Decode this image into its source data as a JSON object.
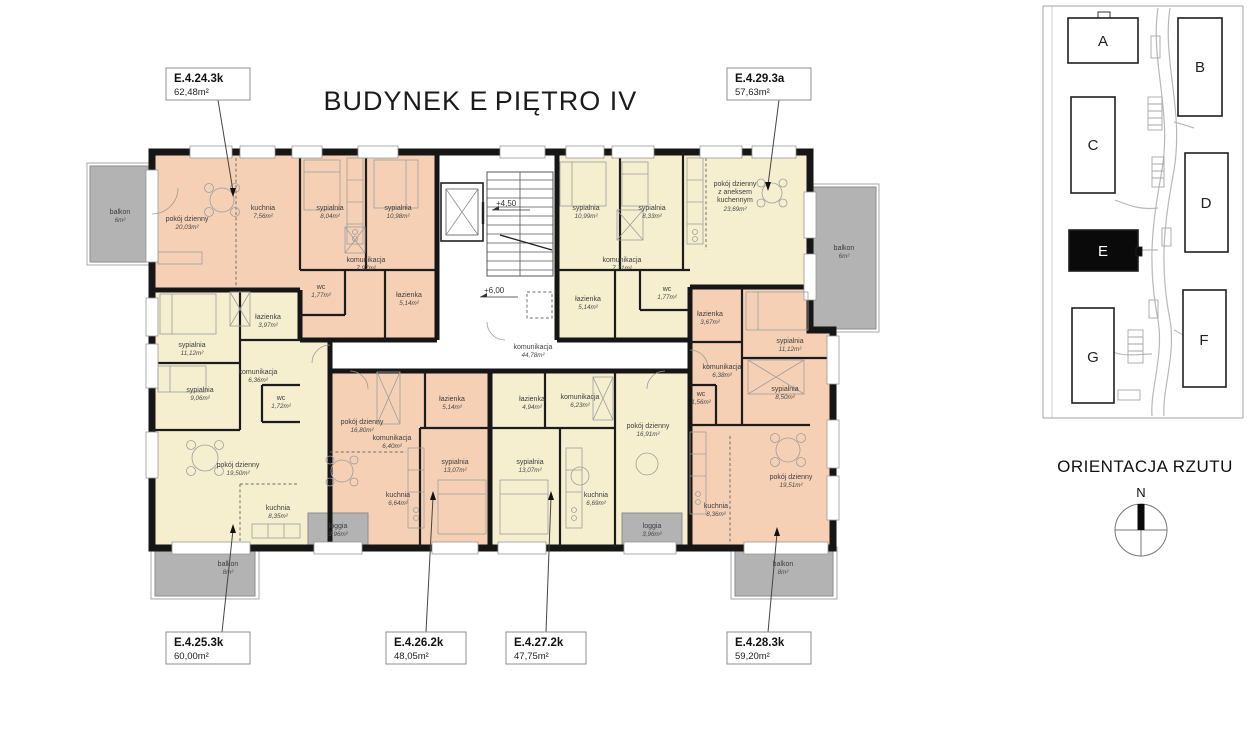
{
  "header": {
    "building": "BUDYNEK E",
    "floor": "PIĘTRO IV"
  },
  "levels": {
    "upper": "+4,50",
    "lower": "+6,00"
  },
  "callouts": [
    {
      "id": "E.4.24.3k",
      "area": "62,48m²"
    },
    {
      "id": "E.4.29.3a",
      "area": "57,63m²"
    },
    {
      "id": "E.4.25.3k",
      "area": "60,00m²"
    },
    {
      "id": "E.4.26.2k",
      "area": "48,05m²"
    },
    {
      "id": "E.4.27.2k",
      "area": "47,75m²"
    },
    {
      "id": "E.4.28.3k",
      "area": "59,20m²"
    }
  ],
  "rooms": [
    {
      "name": "pokój dzienny",
      "area": "20,03m²"
    },
    {
      "name": "kuchnia",
      "area": "7,56m²"
    },
    {
      "name": "sypialnia",
      "area": "8,04m²"
    },
    {
      "name": "sypialnia",
      "area": "10,98m²"
    },
    {
      "name": "komunikacja",
      "area": "7,97m²"
    },
    {
      "name": "wc",
      "area": "1,77m²"
    },
    {
      "name": "łazienka",
      "area": "5,14m²"
    },
    {
      "name": "sypialnia",
      "area": "10,99m²"
    },
    {
      "name": "sypialnia",
      "area": "8,33m²"
    },
    {
      "name": "pokój dzienny",
      "name2": "z aneksem",
      "name3": "kuchennym",
      "area": "23,69m²"
    },
    {
      "name": "komunikacja",
      "area": "7,71m²"
    },
    {
      "name": "łazienka",
      "area": "5,14m²"
    },
    {
      "name": "wc",
      "area": "1,77m²"
    },
    {
      "name": "sypialnia",
      "area": "11,12m²"
    },
    {
      "name": "łazienka",
      "area": "3,97m²"
    },
    {
      "name": "komunikacja",
      "area": "6,36m²"
    },
    {
      "name": "sypialnia",
      "area": "9,06m²"
    },
    {
      "name": "wc",
      "area": "1,72m²"
    },
    {
      "name": "pokój dzienny",
      "area": "19,50m²"
    },
    {
      "name": "kuchnia",
      "area": "8,35m²"
    },
    {
      "name": "pokój dzienny",
      "area": "16,80m²"
    },
    {
      "name": "komunikacja",
      "area": "6,40m²"
    },
    {
      "name": "łazienka",
      "area": "5,14m²"
    },
    {
      "name": "sypialnia",
      "area": "13,07m²"
    },
    {
      "name": "kuchnia",
      "area": "6,64m²"
    },
    {
      "name": "łazienka",
      "area": "4,94m²"
    },
    {
      "name": "komunikacja",
      "area": "6,23m²"
    },
    {
      "name": "sypialnia",
      "area": "13,07m²"
    },
    {
      "name": "kuchnia",
      "area": "6,69m²"
    },
    {
      "name": "pokój dzienny",
      "area": "16,91m²"
    },
    {
      "name": "łazienka",
      "area": "3,67m²"
    },
    {
      "name": "sypialnia",
      "area": "11,12m²"
    },
    {
      "name": "komunikacja",
      "area": "6,38m²"
    },
    {
      "name": "wc",
      "area": "1,56m²"
    },
    {
      "name": "sypialnia",
      "area": "8,50m²"
    },
    {
      "name": "pokój dzienny",
      "area": "19,51m²"
    },
    {
      "name": "kuchnia",
      "area": "8,36m²"
    },
    {
      "name": "komunikacja",
      "area": "44,78m²"
    },
    {
      "name": "balkon",
      "area": "6m²"
    },
    {
      "name": "balkon",
      "area": "6m²"
    },
    {
      "name": "balkon",
      "area": "8m²"
    },
    {
      "name": "balkon",
      "area": "8m²"
    },
    {
      "name": "loggia",
      "area": "3,96m²"
    },
    {
      "name": "loggia",
      "area": "3,96m²"
    }
  ],
  "site_plan": {
    "buildings": [
      {
        "label": "A"
      },
      {
        "label": "B"
      },
      {
        "label": "C"
      },
      {
        "label": "D"
      },
      {
        "label": "E"
      },
      {
        "label": "F"
      },
      {
        "label": "G"
      }
    ],
    "highlighted": "E"
  },
  "compass": {
    "title": "ORIENTACJA RZUTU",
    "north_label": "N"
  },
  "colors": {
    "unit_warm": "#f5d0b5",
    "unit_cream": "#f5efd0",
    "balcony_gray": "#b3b3b3",
    "wall": "#161616"
  }
}
